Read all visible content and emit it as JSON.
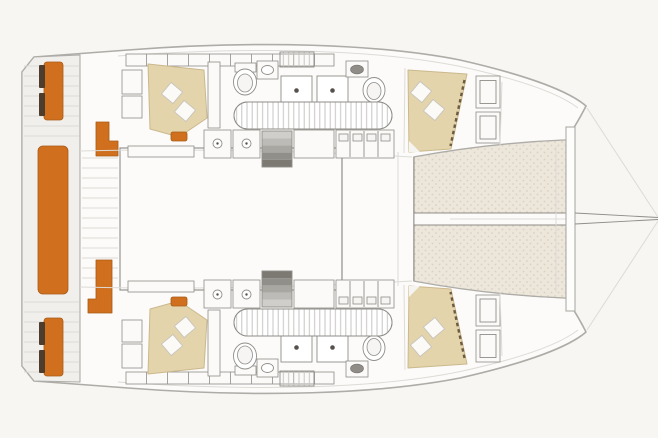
{
  "diagram": {
    "type": "boat-floor-plan",
    "subject": "catamaran deck and accommodation plan, top view, bow pointing right",
    "colors": {
      "background": "#f7f6f3",
      "hull_fill": "#fcfbfa",
      "deck_fill": "#f1efec",
      "outline": "#aeaca7",
      "line_soft": "#dddbd6",
      "fixture": "#8f8d88",
      "slat": "#c8c6c1",
      "accent_orange": "#d0701e",
      "accent_orange_dark": "#a85a14",
      "seat_dark": "#4e3d2c",
      "bed_tan": "#e4d4ab",
      "bed_stroke": "#cbb88d",
      "pillow": "#fbfaf7",
      "trampoline_fill": "#ece6db",
      "trampoline_dot": "#d9d1c1"
    },
    "regions": [
      {
        "id": "stern-platform",
        "label": "Stern platform"
      },
      {
        "id": "aft-cockpit",
        "label": "Aft cockpit"
      },
      {
        "id": "transom-bench",
        "label": "Transom bench seat"
      },
      {
        "id": "helm-seat-upper",
        "label": "Upper aft seat"
      },
      {
        "id": "helm-seat-lower",
        "label": "Lower aft seat"
      },
      {
        "id": "cockpit-bench-upper",
        "label": "Upper cockpit L-bench"
      },
      {
        "id": "cockpit-bench-lower",
        "label": "Lower cockpit L-bench"
      },
      {
        "id": "saloon",
        "label": "Saloon"
      },
      {
        "id": "forward-cockpit",
        "label": "Forward cockpit"
      },
      {
        "id": "port-hull",
        "label": "Port hull (top)"
      },
      {
        "id": "starboard-hull",
        "label": "Starboard hull (bottom, mirrored)"
      },
      {
        "id": "aft-cabin-bed",
        "label": "Aft cabin double bed with pillows"
      },
      {
        "id": "forward-cabin-bed",
        "label": "Forward cabin double bed with pillows"
      },
      {
        "id": "bathroom",
        "label": "Head with toilet and washbasin"
      },
      {
        "id": "shower",
        "label": "Shower grate"
      },
      {
        "id": "galley-counter",
        "label": "Galley counter with sink"
      },
      {
        "id": "companionway-steps",
        "label": "Companionway steps into hull"
      },
      {
        "id": "hull-corridor",
        "label": "Slatted hull corridor / berth"
      },
      {
        "id": "trampoline",
        "label": "Bow trampoline net"
      },
      {
        "id": "crossbeam",
        "label": "Forward crossbeam"
      },
      {
        "id": "bowsprit",
        "label": "Bowsprit and forestay lines"
      }
    ]
  }
}
